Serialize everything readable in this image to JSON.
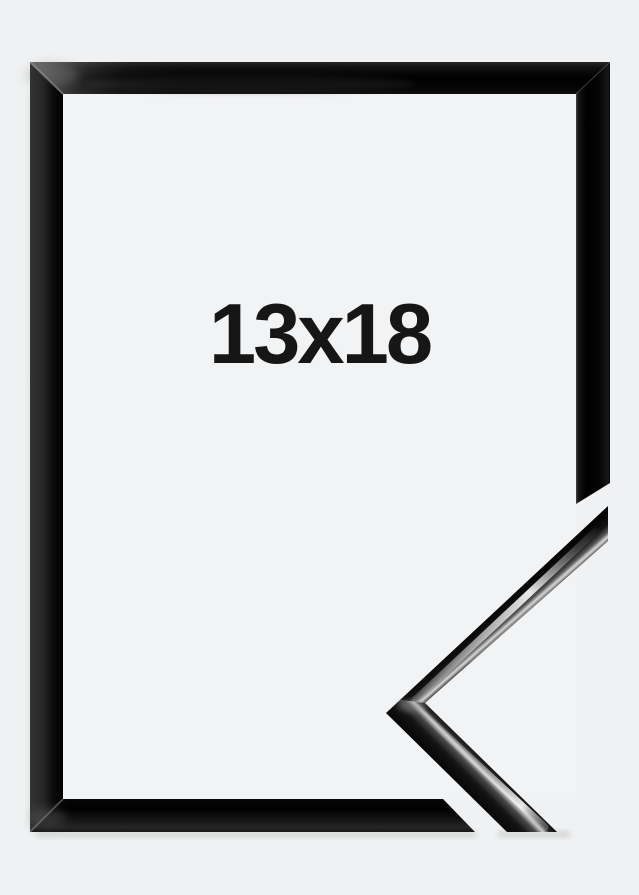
{
  "product_image": {
    "size_label": "13x18",
    "colors": {
      "background": "#f0f1f2",
      "frame_gloss_black": "#0a0a0a",
      "frame_specular_highlight": "#d9d9d9",
      "label_text": "#161616"
    }
  }
}
